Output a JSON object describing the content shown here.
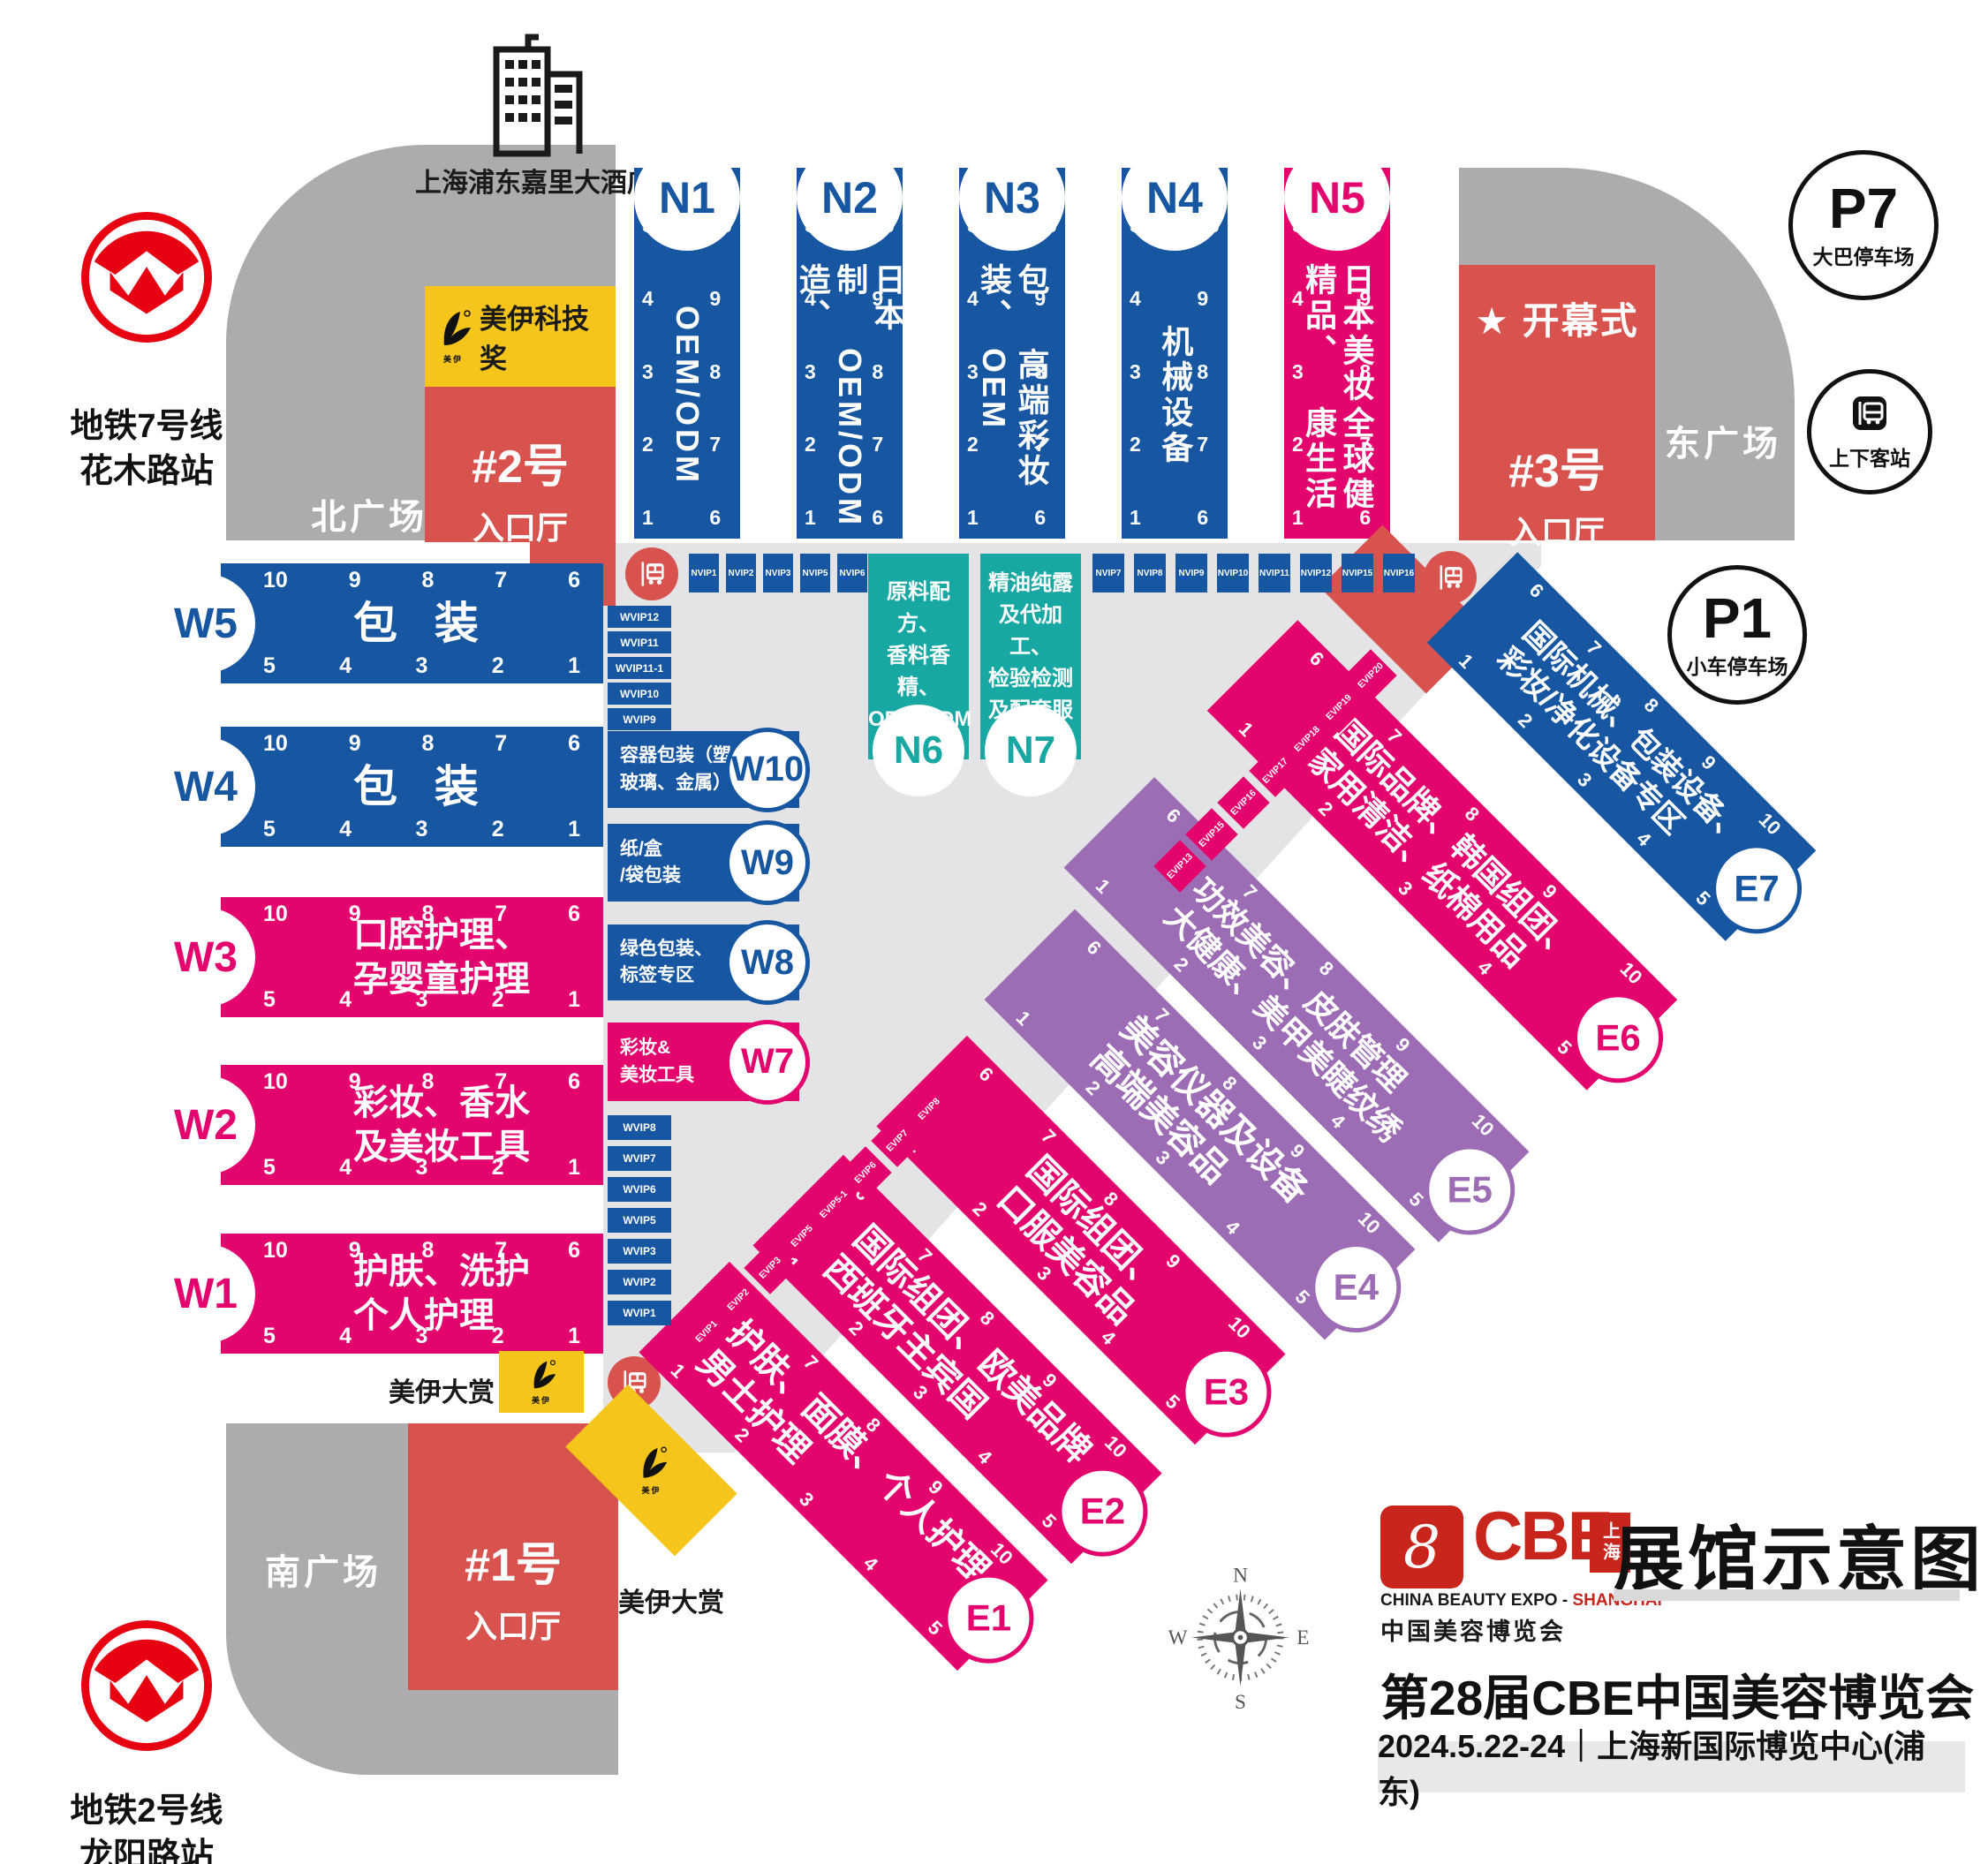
{
  "colors": {
    "blue": "#1757A2",
    "pink": "#E4046E",
    "purple": "#9C6CB4",
    "teal": "#18A8A4",
    "red": "#D9534E",
    "yellow": "#F6C51B",
    "gray": "#ACACAE",
    "lightgray": "#E4E4E6",
    "metro": "#E60012",
    "ink": "#1A1A1A"
  },
  "landmarks": {
    "hotel": {
      "label": "上海浦东嘉里大酒店"
    },
    "metro_line7": {
      "line1": "地铁7号线",
      "line2": "花木路站"
    },
    "metro_line2": {
      "line1": "地铁2号线",
      "line2": "龙阳路站"
    },
    "north_plaza": "北广场",
    "east_plaza": "东广场",
    "south_plaza": "南广场",
    "p7": {
      "code": "P7",
      "label": "大巴停车场"
    },
    "p1": {
      "code": "P1",
      "label": "小车停车场"
    },
    "pickup": {
      "label": "上下客站"
    }
  },
  "entrances": {
    "no2": {
      "name": "#2号",
      "hall": "入口厅"
    },
    "no3": {
      "name": "#3号",
      "hall": "入口厅",
      "ceremony": "开幕式",
      "star": "★"
    },
    "no1": {
      "name": "#1号",
      "hall": "入口厅"
    }
  },
  "awards": {
    "tech": "美伊科技奖",
    "grand_top": "美伊大赏",
    "grand_bottom": "美伊大赏",
    "brand": "美伊"
  },
  "number_strips": {
    "w_top": [
      "10",
      "9",
      "8",
      "7",
      "6"
    ],
    "w_bottom": [
      "5",
      "4",
      "3",
      "2",
      "1"
    ],
    "n_left": [
      "5",
      "4",
      "3",
      "2",
      "1"
    ],
    "n_right": [
      "10",
      "9",
      "8",
      "7",
      "6"
    ],
    "e_upper": [
      "6",
      "7",
      "8",
      "9",
      "10"
    ],
    "e_lower": [
      "1",
      "2",
      "3",
      "4",
      "5"
    ]
  },
  "halls": {
    "north": [
      {
        "id": "N1",
        "cols": [
          "OEM/ODM"
        ]
      },
      {
        "id": "N2",
        "cols": [
          "日本制造、",
          "OEM/ODM"
        ]
      },
      {
        "id": "N3",
        "cols": [
          "包装、",
          "高端彩妆OEM"
        ]
      },
      {
        "id": "N4",
        "cols": [
          "机械设备"
        ]
      },
      {
        "id": "N5",
        "cols": [
          "日本美妆精品、",
          "全球健康生活"
        ]
      }
    ],
    "north_annex": [
      {
        "id": "N6",
        "lines": [
          "原料配方、",
          "香料香精、",
          "OEM/ODM"
        ]
      },
      {
        "id": "N7",
        "lines": [
          "精油纯露",
          "及代加工、",
          "检验检测",
          "及配套服务"
        ]
      }
    ],
    "west": [
      {
        "id": "W5",
        "lines": [
          "包 装"
        ]
      },
      {
        "id": "W4",
        "lines": [
          "包 装"
        ]
      },
      {
        "id": "W3",
        "lines": [
          "口腔护理、",
          "孕婴童护理"
        ]
      },
      {
        "id": "W2",
        "lines": [
          "彩妆、香水",
          "及美妆工具"
        ]
      },
      {
        "id": "W1",
        "lines": [
          "护肤、洗护",
          "个人护理"
        ]
      }
    ],
    "west_annex": [
      {
        "id": "W10",
        "lines": [
          "容器包装（塑料、",
          "玻璃、金属）"
        ]
      },
      {
        "id": "W9",
        "lines": [
          "纸/盒",
          "/袋包装"
        ]
      },
      {
        "id": "W8",
        "lines": [
          "绿色包装、",
          "标签专区"
        ]
      },
      {
        "id": "W7",
        "lines": [
          "彩妆&",
          "美妆工具"
        ]
      }
    ],
    "east": [
      {
        "id": "E1",
        "lines": [
          "护肤、面膜、个人护理",
          "男士护理"
        ]
      },
      {
        "id": "E2",
        "lines": [
          "国际组团、欧美品牌",
          "西班牙主宾国"
        ]
      },
      {
        "id": "E3",
        "lines": [
          "国际组团、",
          "口服美容品"
        ]
      },
      {
        "id": "E4",
        "lines": [
          "美容仪器及设备",
          "高端美容品"
        ]
      },
      {
        "id": "E5",
        "lines": [
          "功效美容、皮肤管理",
          "大健康、美甲美睫纹绣"
        ]
      },
      {
        "id": "E6",
        "lines": [
          "国际品牌、韩国组团、",
          "家用清洁、纸棉用品"
        ]
      },
      {
        "id": "E7",
        "lines": [
          "国际机械、包装设备、",
          "彩妆/净化设备专区"
        ]
      }
    ]
  },
  "vip": {
    "nvip_left": [
      "NVIP1",
      "NVIP2",
      "NVIP3",
      "NVIP5",
      "NVIP6"
    ],
    "nvip_right": [
      "NVIP7",
      "NVIP8",
      "NVIP9",
      "NVIP10",
      "NVIP11",
      "NVIP12",
      "NVIP15",
      "NVIP16"
    ],
    "wvip_top": [
      "WVIP12",
      "WVIP11",
      "WVIP11-1",
      "WVIP10",
      "WVIP9"
    ],
    "wvip_bottom": [
      "WVIP8",
      "WVIP7",
      "WVIP6",
      "WVIP5",
      "WVIP3",
      "WVIP2",
      "WVIP1"
    ],
    "evip_lower": [
      "EVIP1",
      "EVIP2",
      "EVIP3",
      "EVIP5",
      "EVIP5-1",
      "EVIP6",
      "EVIP7",
      "EVIP8"
    ],
    "evip_upper": [
      "EVIP13",
      "EVIP15",
      "EVIP16",
      "EVIP17",
      "EVIP18",
      "EVIP19",
      "EVIP20"
    ]
  },
  "compass": {
    "n": "N",
    "e": "E",
    "s": "S",
    "w": "W"
  },
  "footer": {
    "logo_word": "CBE",
    "logo_city": "上海",
    "logo_sub_black": "CHINA BEAUTY EXPO - ",
    "logo_sub_red": "SHANGHAI",
    "logo_cn": "中国美容博览会",
    "map_title": "展馆示意图",
    "expo_title": "第28届CBE中国美容博览会",
    "date_venue": "2024.5.22-24｜上海新国际博览中心(浦东)"
  }
}
